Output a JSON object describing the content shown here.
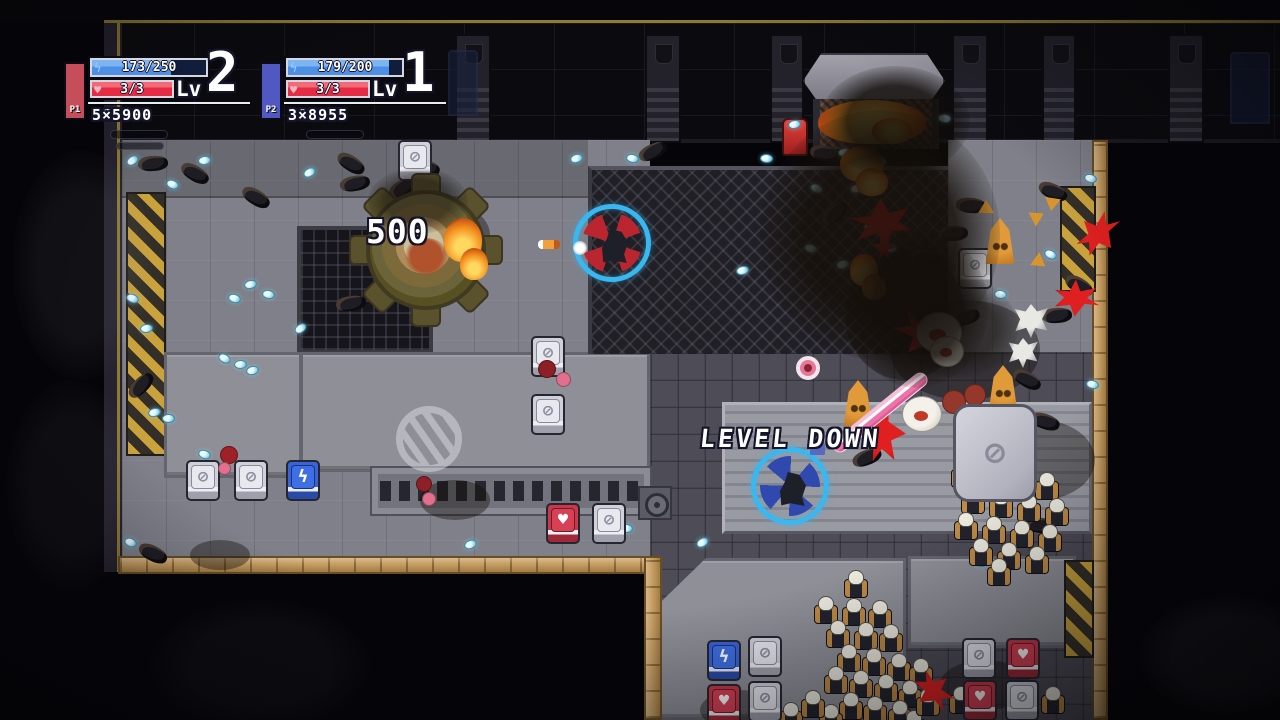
{
  "hud": {
    "players": [
      {
        "tag": "P1",
        "hp_text": "173/250",
        "hp_pct": 69,
        "life_text": "3/3",
        "life_pct": 100,
        "lv_label": "Lv",
        "level": "2",
        "score": "566900",
        "mult": "×5"
      },
      {
        "tag": "P2",
        "hp_text": "179/200",
        "hp_pct": 89,
        "life_text": "3/3",
        "life_pct": 100,
        "lv_label": "Lv",
        "level": "1",
        "score": "302955",
        "mult": "×8"
      }
    ],
    "hp_icon": "ϟ",
    "life_icon": "♥"
  },
  "overlays": {
    "damage_popup": "500",
    "status_text": "LEVEL DOWN"
  },
  "colors": {
    "hp": "#4d8ee6",
    "hpLight": "#7db4f2",
    "life": "#e62c44",
    "p1_tag": "#c64e5a",
    "p2_tag": "#5158c2",
    "ring": "#38b8f0"
  },
  "symbols": {
    "none": "⊘",
    "heart": "♥",
    "bolt": "ϟ"
  },
  "entities": {
    "soldiers": [
      [
        843,
        570
      ],
      [
        813,
        596
      ],
      [
        841,
        598
      ],
      [
        867,
        600
      ],
      [
        825,
        620
      ],
      [
        853,
        622
      ],
      [
        878,
        624
      ],
      [
        836,
        644
      ],
      [
        861,
        648
      ],
      [
        886,
        653
      ],
      [
        908,
        658
      ],
      [
        823,
        666
      ],
      [
        848,
        670
      ],
      [
        873,
        674
      ],
      [
        897,
        680
      ],
      [
        838,
        692
      ],
      [
        862,
        696
      ],
      [
        887,
        700
      ],
      [
        818,
        704
      ],
      [
        901,
        710
      ],
      [
        915,
        688
      ],
      [
        950,
        460
      ],
      [
        978,
        464
      ],
      [
        1006,
        468
      ],
      [
        1034,
        472
      ],
      [
        960,
        486
      ],
      [
        988,
        490
      ],
      [
        1016,
        494
      ],
      [
        1044,
        498
      ],
      [
        953,
        512
      ],
      [
        981,
        516
      ],
      [
        1009,
        520
      ],
      [
        1037,
        524
      ],
      [
        968,
        538
      ],
      [
        996,
        542
      ],
      [
        1024,
        546
      ],
      [
        986,
        558
      ],
      [
        948,
        686
      ],
      [
        1006,
        698
      ],
      [
        1040,
        686
      ],
      [
        778,
        702
      ],
      [
        800,
        690
      ]
    ],
    "bodies": [
      [
        138,
        156
      ],
      [
        180,
        166
      ],
      [
        241,
        190
      ],
      [
        336,
        156
      ],
      [
        388,
        180
      ],
      [
        126,
        378
      ],
      [
        138,
        546
      ],
      [
        810,
        146
      ],
      [
        820,
        206
      ],
      [
        938,
        226
      ],
      [
        956,
        198
      ],
      [
        1038,
        184
      ],
      [
        1064,
        278
      ],
      [
        1012,
        372
      ],
      [
        1026,
        518
      ],
      [
        852,
        450
      ],
      [
        638,
        144
      ],
      [
        910,
        250
      ],
      [
        1042,
        308
      ],
      [
        950,
        310
      ],
      [
        1030,
        414
      ],
      [
        340,
        176
      ],
      [
        410,
        160
      ],
      [
        336,
        296
      ]
    ],
    "orbs": [
      [
        126,
        156
      ],
      [
        166,
        180
      ],
      [
        198,
        156
      ],
      [
        228,
        294
      ],
      [
        244,
        280
      ],
      [
        262,
        290
      ],
      [
        198,
        450
      ],
      [
        210,
        464
      ],
      [
        124,
        538
      ],
      [
        464,
        540
      ],
      [
        620,
        524
      ],
      [
        696,
        538
      ],
      [
        974,
        558
      ],
      [
        126,
        294
      ],
      [
        140,
        324
      ],
      [
        148,
        408
      ],
      [
        162,
        414
      ],
      [
        218,
        354
      ],
      [
        234,
        360
      ],
      [
        246,
        366
      ],
      [
        294,
        324
      ],
      [
        303,
        168
      ],
      [
        1084,
        174
      ],
      [
        1044,
        250
      ],
      [
        1086,
        380
      ],
      [
        974,
        274
      ],
      [
        994,
        290
      ],
      [
        938,
        114
      ],
      [
        788,
        120
      ],
      [
        760,
        154
      ],
      [
        626,
        154
      ],
      [
        570,
        154
      ],
      [
        838,
        148
      ],
      [
        850,
        184
      ],
      [
        810,
        184
      ],
      [
        864,
        224
      ],
      [
        884,
        244
      ],
      [
        836,
        260
      ],
      [
        804,
        244
      ],
      [
        874,
        156
      ],
      [
        736,
        266
      ]
    ],
    "crates": [
      {
        "t": "none",
        "x": 398,
        "y": 140
      },
      {
        "t": "none",
        "x": 531,
        "y": 336
      },
      {
        "t": "none",
        "x": 531,
        "y": 394
      },
      {
        "t": "heart",
        "x": 546,
        "y": 503
      },
      {
        "t": "none",
        "x": 592,
        "y": 503
      },
      {
        "t": "none",
        "x": 186,
        "y": 460
      },
      {
        "t": "none",
        "x": 234,
        "y": 460
      },
      {
        "t": "bolt",
        "x": 286,
        "y": 460
      },
      {
        "t": "none",
        "x": 958,
        "y": 248
      },
      {
        "t": "bolt",
        "x": 707,
        "y": 640
      },
      {
        "t": "none",
        "x": 748,
        "y": 636
      },
      {
        "t": "heart",
        "x": 707,
        "y": 684
      },
      {
        "t": "none",
        "x": 748,
        "y": 681
      },
      {
        "t": "none",
        "x": 962,
        "y": 638
      },
      {
        "t": "heart",
        "x": 1006,
        "y": 638
      },
      {
        "t": "heart",
        "x": 963,
        "y": 680
      },
      {
        "t": "none",
        "x": 1005,
        "y": 680
      }
    ],
    "splats": [
      [
        850,
        198,
        62
      ],
      [
        893,
        310,
        58
      ],
      [
        852,
        408,
        60
      ],
      [
        1075,
        214,
        48
      ],
      [
        1054,
        280,
        46
      ],
      [
        912,
        674,
        44
      ],
      [
        870,
        236,
        28
      ]
    ],
    "white_blobs": [
      [
        916,
        312,
        46
      ],
      [
        902,
        396,
        40
      ],
      [
        930,
        336,
        34
      ]
    ],
    "white_spiky": [
      [
        1014,
        304,
        34
      ],
      [
        1008,
        338,
        30
      ]
    ],
    "orange_creatures": [
      [
        982,
        218
      ],
      [
        840,
        380
      ],
      [
        985,
        365
      ]
    ],
    "triangles": [
      [
        978,
        200
      ],
      [
        1030,
        210
      ],
      [
        1032,
        256
      ],
      [
        1044,
        198
      ]
    ],
    "balls": [
      [
        538,
        360,
        "#8c2026",
        18
      ],
      [
        556,
        372,
        "#e0708e",
        15
      ],
      [
        416,
        476,
        "#8c2026",
        16
      ],
      [
        422,
        492,
        "#e0708e",
        14
      ],
      [
        220,
        446,
        "#a02028",
        18
      ],
      [
        218,
        462,
        "#e0708e",
        13
      ],
      [
        942,
        390,
        "#96372c",
        24
      ],
      [
        964,
        384,
        "#96372c",
        22
      ]
    ],
    "flames": [
      [
        840,
        146,
        44,
        36
      ],
      [
        856,
        168,
        32,
        28
      ],
      [
        850,
        254,
        28,
        32
      ],
      [
        862,
        274,
        24,
        26
      ],
      [
        444,
        218,
        38,
        44
      ],
      [
        460,
        248,
        28,
        32
      ],
      [
        818,
        100,
        108,
        44
      ],
      [
        872,
        118,
        40,
        26
      ]
    ],
    "smokes": [
      [
        760,
        110,
        240,
        250,
        "rgba(22,16,10,0.85)"
      ],
      [
        820,
        66,
        150,
        110,
        "rgba(15,12,8,0.8)"
      ],
      [
        848,
        228,
        140,
        160,
        "rgba(20,14,10,0.75)"
      ],
      [
        368,
        168,
        100,
        66,
        "rgba(20,16,12,0.5)"
      ],
      [
        898,
        278,
        120,
        100,
        "rgba(18,14,10,0.5)"
      ],
      [
        1140,
        596,
        180,
        120,
        "rgba(120,120,130,0.12)"
      ],
      [
        12,
        150,
        140,
        230,
        "rgba(130,130,140,0.1)"
      ],
      [
        6,
        380,
        130,
        210,
        "rgba(130,130,140,0.08)"
      ],
      [
        150,
        600,
        220,
        130,
        "rgba(130,130,140,0.07)"
      ]
    ],
    "stains": [
      [
        845,
        250,
        120,
        130
      ],
      [
        890,
        300,
        150,
        100
      ],
      [
        380,
        200,
        110,
        70
      ],
      [
        940,
        660,
        90,
        50
      ],
      [
        190,
        540,
        60,
        30
      ],
      [
        420,
        480,
        70,
        40
      ],
      [
        700,
        690,
        80,
        40
      ],
      [
        985,
        420,
        110,
        80
      ]
    ]
  }
}
